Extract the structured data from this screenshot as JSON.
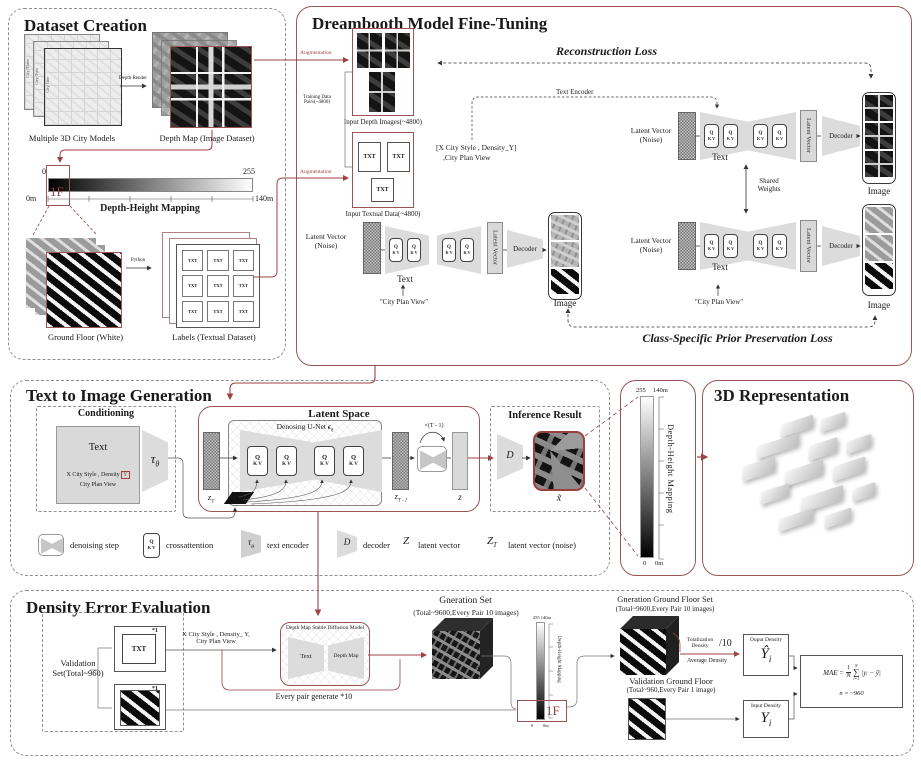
{
  "colors": {
    "accent": "#9c4a4a"
  },
  "dataset": {
    "title": "Dataset Creation",
    "city_stack_labels": [
      "City Three",
      "City Two",
      "City One"
    ],
    "city_models_caption": "Multiple 3D City Models",
    "depth_render_label": "Depth Render",
    "depth_map_caption": "Depth Map (Image Dataset)",
    "bar": {
      "left_top": "0",
      "right_top": "255",
      "left_bottom": "0m",
      "right_bottom": "140m",
      "floor": "1F",
      "caption": "Depth-Height Mapping"
    },
    "python_label": "Python",
    "ground_floor_caption": "Ground Floor (White)",
    "labels_caption": "Labels (Textual Dataset)",
    "txt": "TXT"
  },
  "dreambooth": {
    "title": "Dreambooth Model Fine-Tuning",
    "augmentation": "Augmentation",
    "training_line1": "Training Data",
    "training_line2": "Pairs(~4800)",
    "input_depth_caption": "Input Depth Images(~4800)",
    "input_text_caption": "Input Textual Data(~4800)",
    "prompt_line1": "[X City Style , Density_Y]",
    "prompt_line2": ",City Plan View",
    "text_encoder": "Text Encoder",
    "reconstruction_loss": "Reconstruction Loss",
    "class_loss": "Class-Specific Prior Preservation Loss",
    "latent_vector_line1": "Latent Vector",
    "latent_vector_line2": "(Noise)",
    "latent_vector": "Latent Vector",
    "decoder": "Decoder",
    "text": "Text",
    "image": "Image",
    "shared_line1": "Shared",
    "shared_line2": "Weights",
    "city_plan_view": "\"City Plan View\"",
    "q": "Q",
    "kv": "K V",
    "txt": "TXT"
  },
  "t2i": {
    "title": "Text to Image Generation",
    "conditioning": "Conditioning",
    "text": "Text",
    "prompt_line1": "X City Style , Density",
    "prompt_y": "Y",
    "prompt_line2": "City Plan View",
    "tau": "τ",
    "theta": "θ",
    "latent_space": "Latent Space",
    "unet_title": "Denosing U-Net ",
    "epsilon": "ϵ",
    "z": "z",
    "sub_t": "T",
    "sub_t1": "T - 1",
    "loop": "×(T - 1)",
    "inference": "Inference Result",
    "d": "D",
    "x_tilde": "x̃",
    "legend": {
      "denoising": "denoising step",
      "crossattention": "crossattention",
      "text_encoder": "text encoder",
      "decoder": "decoder",
      "latent_vector": "latent vector",
      "latent_vector_noise": "latent vector (noise)",
      "z_cap": "Z",
      "z_sub": "T",
      "d": "D",
      "tau": "τ",
      "theta": "θ",
      "q": "Q",
      "kv": "K V"
    }
  },
  "colorbar": {
    "top_val": "255",
    "top_m": "140m",
    "label": "Depth-Height Mapping",
    "bottom_val": "0",
    "bottom_m": "0m"
  },
  "rep3d": {
    "title": "3D Representation"
  },
  "density": {
    "title": "Density Error Evaluation",
    "validation_line1": "Validation",
    "validation_line2": "Set(Total~960)",
    "star1": "*1",
    "txt": "TXT",
    "prompt_line1": "X City Style , Density_ Y,",
    "prompt_line2": "City Plan View",
    "sd_title": "Depth Map Stable Diffusion Model",
    "sd_text": "Text",
    "sd_depth": "Depth Map",
    "every_pair": "Every pair generate *10",
    "gen_set": "Gneration Set",
    "gen_set_sub": "(Total~9600,Every Pair 10 images)",
    "bar_top": "255 140m",
    "bar_label": "Depth-Height Mapping",
    "bar_floor": "1F",
    "bar_bottom_val": "0",
    "bar_bottom_m": "0m",
    "ggf": "Gneration Ground Floor Set",
    "ggf_sub": "(Total~9600,Every Pair 10 images)",
    "totalization_line1": "Totalization",
    "totalization_line2": "Density",
    "div10": "/10",
    "avg_density": "Average Density",
    "output_density": "Ouput Density",
    "y_hat": "Ŷ",
    "sub_i": "i",
    "vgf": "Validation Ground Floor",
    "vgf_sub": "(Total~960,Every Pair 1 image)",
    "input_density": "Input Density",
    "y": "Y",
    "mae_lhs": "MAE =",
    "mae_num": "1",
    "mae_den": "N",
    "sigma": "∑",
    "sigma_sup": "N",
    "sigma_sub": "i=1",
    "mae_term": "|yᵢ − ŷ|",
    "mae_note": "n = ~960"
  }
}
